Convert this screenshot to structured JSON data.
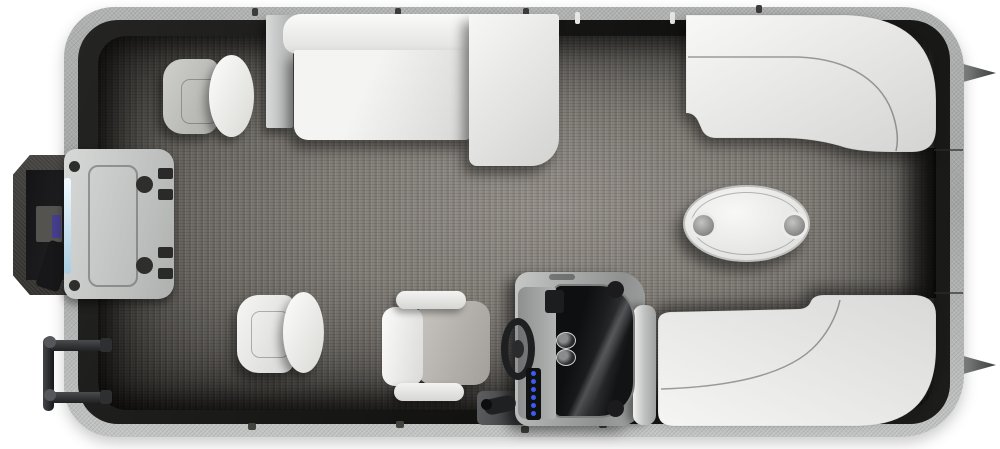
{
  "scene": {
    "subject": "pontoon-boat-floorplan-top-view",
    "orientation": {
      "bow": "right",
      "stern": "left",
      "port": "top",
      "starboard": "bottom"
    }
  },
  "colors": {
    "page-bg": "#ffffff",
    "rim": "#b0b2b1",
    "wall": "#161614",
    "carpet-light": "#948f89",
    "carpet-dark": "#37342f",
    "seat-white": "#f4f4f2",
    "seat-shadow": "#d5d5d3",
    "captain-seat-gray": "#b5b2ad",
    "console-metal": "#a9abaa",
    "windscreen": "#16171a",
    "switch-blue": "#3d5bf0",
    "motor-accent": "#453e8c",
    "pod-panel": "#c9cbca",
    "table-white": "#efefed",
    "cupholder": "#8e8e8c"
  },
  "parts": {
    "hull": "Pontoon deck with fence rim",
    "carpet": "Gray woven marine carpet floor",
    "bow_gate": "Bow boarding gate",
    "side_gate": "Port side gate opening",
    "nose_cone_port": "Port pontoon nose cone",
    "nose_cone_starboard": "Starboard pontoon nose cone",
    "motor_well": "Stern motor well",
    "outboard_motor": "Outboard motor",
    "motor_pod_panel": "Stern pod access panel with hatch",
    "boarding_ladder": "Folded boarding ladder",
    "aft_port_chair": "Aft-facing port chair",
    "port_bench": "Port side bench seat",
    "port_bow_lounge": "Curved port bow corner lounge",
    "starboard_bow_lounge": "Curved starboard bow corner lounge",
    "starboard_chair": "Starboard side chair",
    "captain_chair": "Captain's chair with armrests",
    "helm_console": "Helm console",
    "steering_wheel": "Steering wheel",
    "windscreen": "Console windscreen",
    "gauges": "Helm gauges",
    "switch_panel": "Lighted switch panel",
    "throttle": "Throttle control",
    "grab_rail": "Entry grab rail",
    "table": "Oval cocktail table with cup holders"
  }
}
